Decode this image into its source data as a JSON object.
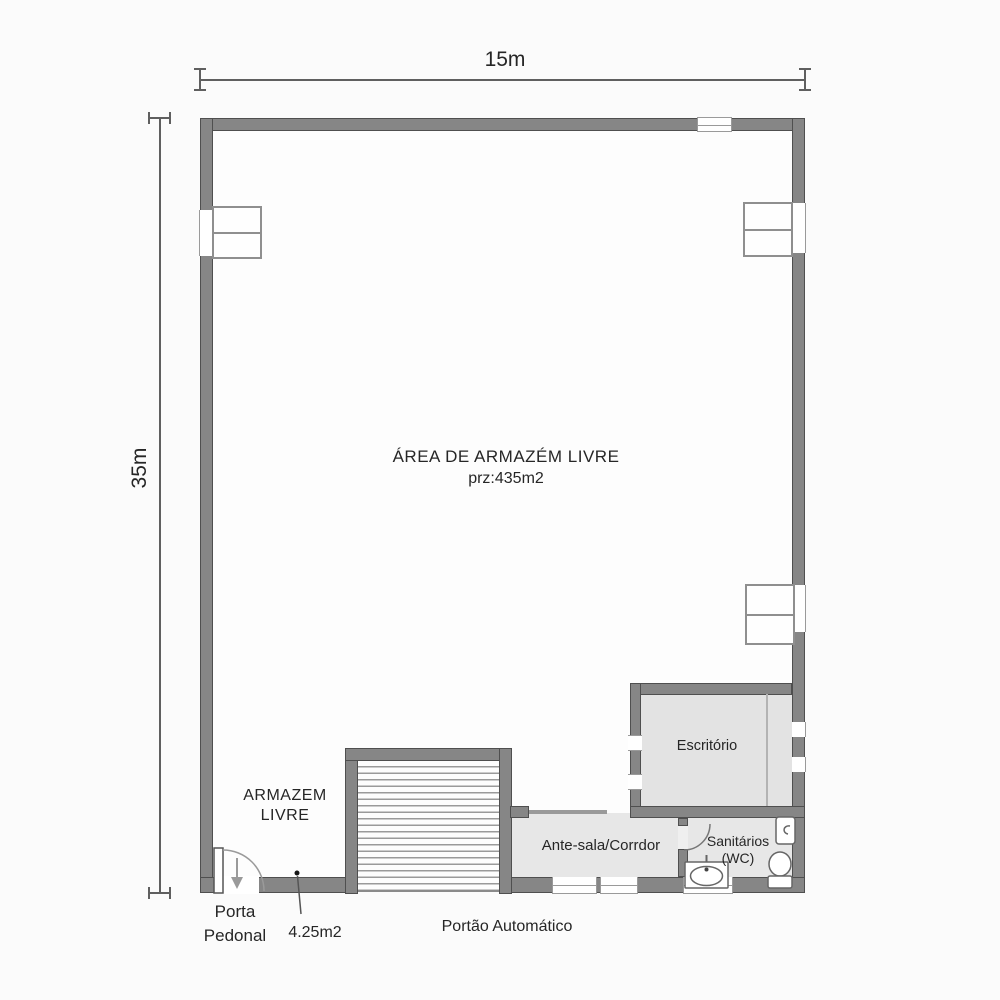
{
  "dimensions": {
    "top": "15m",
    "left": "35m"
  },
  "rooms": {
    "main": {
      "title": "ÁREA DE ARMAZÉM LIVRE",
      "size": "prz:435m2"
    },
    "armazem": {
      "line1": "ARMAZEM",
      "line2": "LIVRE"
    },
    "office": {
      "label": "Escritório"
    },
    "antesala": {
      "label": "Ante-sala/Corrdor"
    },
    "wc": {
      "line1": "Sanitários",
      "line2": "(WC)"
    }
  },
  "annotations": {
    "pedestrian_door": {
      "line1": "Porta",
      "line2": "Pedonal"
    },
    "door_size": "4.25m2",
    "gate": "Portão Automático"
  },
  "icons": {
    "window_icon": "two-pane casement rectangle",
    "door_swing_icon": "quarter-circle arc",
    "arrow_down_icon": "↓",
    "sink_icon": "oval basin in counter",
    "toilet_icon": "bowl with tank",
    "urinal_icon": "small wall-mounted unit",
    "leader_dot_icon": "•"
  },
  "colors": {
    "wall": "#868686",
    "wall_edge": "#4f4f4f",
    "floor_light": "#e7e7e7",
    "floor_main": "#fdfdfd",
    "background": "#fbfbfb",
    "hatch_line": "#9a9a9a",
    "dimension_line": "#5f5f5f",
    "text": "#262626"
  }
}
